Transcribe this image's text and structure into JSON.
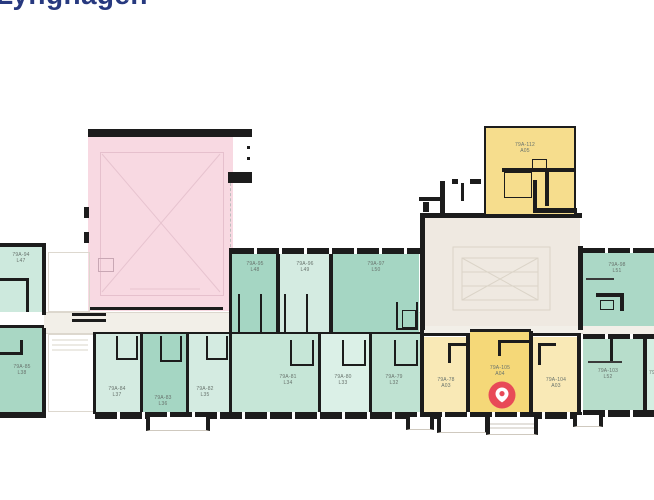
{
  "page": {
    "title": "Lynghagen"
  },
  "palette": {
    "wall": "#1c1c1c",
    "teal_dark": "#a5d6c3",
    "teal_mid": "#b7ddcb",
    "teal_light": "#d4ebe1",
    "pink_hall": "#f8d9e2",
    "yellow_dark": "#f5d878",
    "yellow_light": "#f9e9b6",
    "stair_block": "#efe9e1",
    "corridor": "#f2efe8",
    "marker_red": "#e84a57",
    "title_blue": "#27397f"
  },
  "marker": {
    "type": "location-pin",
    "in_room": "79A-105"
  },
  "rooms": {
    "r94": {
      "code": "79A-94",
      "unit": "L47"
    },
    "r95": {
      "code": "79A-95",
      "unit": "L48"
    },
    "r96": {
      "code": "79A-96",
      "unit": "L49"
    },
    "r97": {
      "code": "79A-97",
      "unit": "L50"
    },
    "r98": {
      "code": "79A-98",
      "unit": "L51"
    },
    "r112": {
      "code": "79A-112",
      "unit": "A05"
    },
    "r85": {
      "code": "79A-85",
      "unit": "L38"
    },
    "r84": {
      "code": "79A-84",
      "unit": "L37"
    },
    "r83": {
      "code": "79A-83",
      "unit": "L36"
    },
    "r82": {
      "code": "79A-82",
      "unit": "L35"
    },
    "r81": {
      "code": "79A-81",
      "unit": "L34"
    },
    "r80": {
      "code": "79A-80",
      "unit": "L33"
    },
    "r79": {
      "code": "79A-79",
      "unit": "L32"
    },
    "r78": {
      "code": "79A-78",
      "unit": "A03"
    },
    "r105": {
      "code": "79A-105",
      "unit": "A04"
    },
    "r104": {
      "code": "79A-104",
      "unit": "A03"
    },
    "r103": {
      "code": "79A-103",
      "unit": "L52"
    },
    "partial_right": {
      "code": "79"
    }
  }
}
